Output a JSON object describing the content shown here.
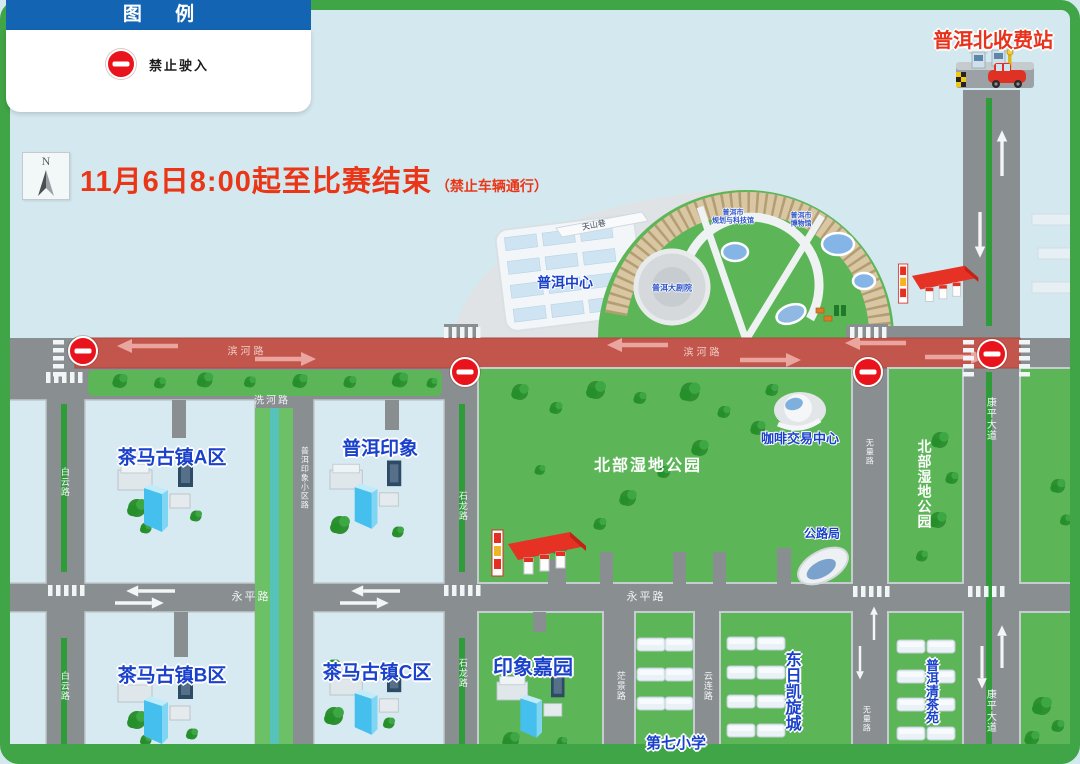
{
  "legend": {
    "title": "图 例",
    "items": [
      {
        "icon": "no-entry",
        "label": "禁止驶入"
      }
    ]
  },
  "compass": {
    "north": "N"
  },
  "banner": {
    "main": "11月6日8:00起至比赛结束",
    "sub": "（禁止车辆通行）"
  },
  "toll": {
    "name": "普洱北收费站"
  },
  "places": {
    "puer_center": "普洱中心",
    "grand_theater": "普洱大剧院",
    "planning_hall": "普洱市\n规划与科技馆",
    "museum": "普洱市\n博物馆",
    "chama_a": "茶马古镇A区",
    "chama_b": "茶马古镇B区",
    "chama_c": "茶马古镇C区",
    "puer_impression": "普洱印象",
    "wetland_park": "北部湿地公园",
    "coffee_center": "咖啡交易中心",
    "highway_bureau": "公路局",
    "yinxiang_jiayuan": "印象嘉园",
    "seventh_primary_school": "第七小学",
    "dongri_triumph_city": "东日凯旋城",
    "puer_qingcha_garden": "普洱清茶苑"
  },
  "roads": {
    "binhe": "滨河路",
    "xihe": "洗河路",
    "baiyun": "白云路",
    "shilong": "石龙路",
    "yongping": "永平路",
    "wuliang": "无量路",
    "kangping": "康平大道",
    "mangjing": "茫景路",
    "yunlian": "云连路",
    "tianshan": "天山巷",
    "impression_estate": "普洱印象小区路"
  },
  "colors": {
    "frame_green": "#3fa546",
    "closed_road_red": "#c2564c",
    "park_green": "#5cb657",
    "label_blue": "#1a41cb",
    "legend_blue": "#1464b4",
    "alert_red": "#e8131b",
    "title_red": "#ea3617"
  }
}
